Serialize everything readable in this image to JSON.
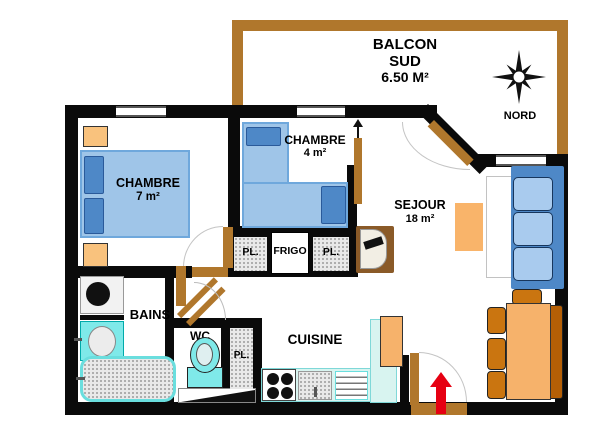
{
  "balcony": {
    "name_line1": "BALCON",
    "name_line2": "SUD",
    "area": "6.50 M²"
  },
  "compass": {
    "north_label": "NORD"
  },
  "bedroom1": {
    "name": "CHAMBRE",
    "area": "7 m²"
  },
  "bedroom2": {
    "name": "CHAMBRE",
    "area": "4 m²"
  },
  "living_room": {
    "name": "SEJOUR",
    "area": "18 m²"
  },
  "bathroom": {
    "name": "BAINS"
  },
  "toilet": {
    "name": "WC"
  },
  "kitchen": {
    "name": "CUISINE"
  },
  "closets": {
    "hall_left": "PL.",
    "fridge": "FRIGO",
    "hall_right": "PL.",
    "corridor": "PL."
  },
  "colors": {
    "wall": "#0a0a0a",
    "wood": "#b0772c",
    "bed_blue": "#9fc5e8",
    "accent_blue": "#4e88c7",
    "cushion_blue": "#a9cbee",
    "orange_light": "#f6b26b",
    "orange_dark": "#ca7510",
    "bench_dark": "#b45f06",
    "fixture_cyan": "#7fe9e9",
    "counter_cyan": "#d8f4f0",
    "arrow_red": "#e60012",
    "tv_brown": "#8a5a28"
  }
}
